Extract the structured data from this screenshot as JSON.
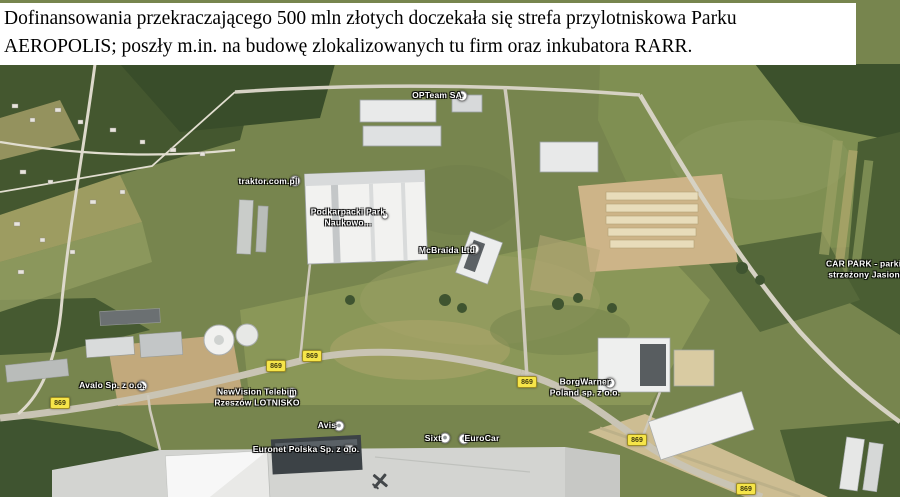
{
  "overlay": {
    "line1": "Dofinansowania przekraczającego 500 mln złotych doczekała się strefa przylotniskowa Parku",
    "line2": "AEROPOLIS; poszły m.in. na budowę zlokalizowanych tu firm oraz inkubatora RARR.",
    "background": "#ffffff",
    "text_color": "#000000"
  },
  "map": {
    "type": "satellite-imagery",
    "area": "Rzeszów-Jasionka / Aeropolis park strefa przylotniskowa",
    "label_text_color": "#ffffff",
    "road_badge_color": "#f6e549",
    "place_labels": [
      {
        "id": "opteam",
        "lines": [
          "OPTeam SA"
        ],
        "marker": "dot"
      },
      {
        "id": "traktor",
        "lines": [
          "traktor.com.pl"
        ],
        "marker": "dot"
      },
      {
        "id": "ppnt",
        "lines": [
          "Podkarpacki Park",
          "Naukowo..."
        ],
        "marker": "dot-small"
      },
      {
        "id": "mcbraida",
        "lines": [
          "McBraida Ltd"
        ],
        "marker": "dot"
      },
      {
        "id": "carpark",
        "lines": [
          "CAR PARK - parking",
          "strzeżony Jasionka"
        ],
        "marker": "none"
      },
      {
        "id": "avalo",
        "lines": [
          "Avalo Sp. z o.o."
        ],
        "marker": "dot"
      },
      {
        "id": "newvision",
        "lines": [
          "NewVision Telebim",
          "Rzeszów LOTNISKO"
        ],
        "marker": "dot"
      },
      {
        "id": "borgwarner",
        "lines": [
          "BorgWarner",
          "Poland sp. z o.o."
        ],
        "marker": "dot"
      },
      {
        "id": "avis",
        "lines": [
          "Avis"
        ],
        "marker": "dot"
      },
      {
        "id": "euronet",
        "lines": [
          "Euronet Polska Sp. z o.o."
        ],
        "marker": "square"
      },
      {
        "id": "sixt",
        "lines": [
          "Sixt"
        ],
        "marker": "dot"
      },
      {
        "id": "eurocar",
        "lines": [
          "EuroCar"
        ],
        "marker": "dot"
      }
    ],
    "road_badges": [
      {
        "label": "869"
      },
      {
        "label": "869"
      },
      {
        "label": "869"
      },
      {
        "label": "869"
      },
      {
        "label": "869"
      },
      {
        "label": "869"
      }
    ]
  }
}
